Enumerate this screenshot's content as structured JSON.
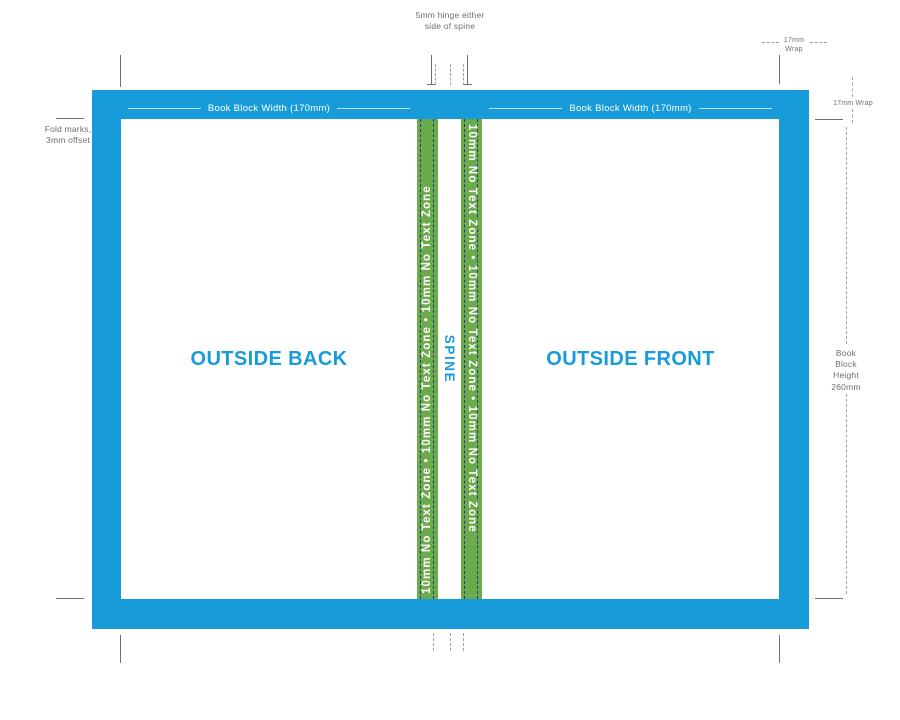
{
  "colors": {
    "frame_blue": "#189cd9",
    "zone_green": "#6cab4b",
    "fold_line_navy": "#223a7e",
    "annotation_gray": "#6d6e71",
    "measure_line_white": "#ffffff"
  },
  "cover": {
    "outside_back_label": "OUTSIDE BACK",
    "outside_front_label": "OUTSIDE FRONT",
    "spine_label": "SPINE",
    "no_text_zone_left": "10mm No Text Zone • 10mm No Text Zone • 10mm No Text Zone",
    "no_text_zone_right": "10mm No Text Zone • 10mm No Text Zone • 10mm No Text Zone",
    "book_block_width_back": "Book Block Width (170mm)",
    "book_block_width_front": "Book Block Width (170mm)"
  },
  "annotations": {
    "hinge_note": "5mm hinge either\nside of spine",
    "wrap_top": "17mm\nWrap",
    "wrap_right": "17mm Wrap",
    "fold_marks": "Fold marks,\n3mm offset",
    "book_block_height": "Book\nBlock\nHeight\n260mm"
  }
}
